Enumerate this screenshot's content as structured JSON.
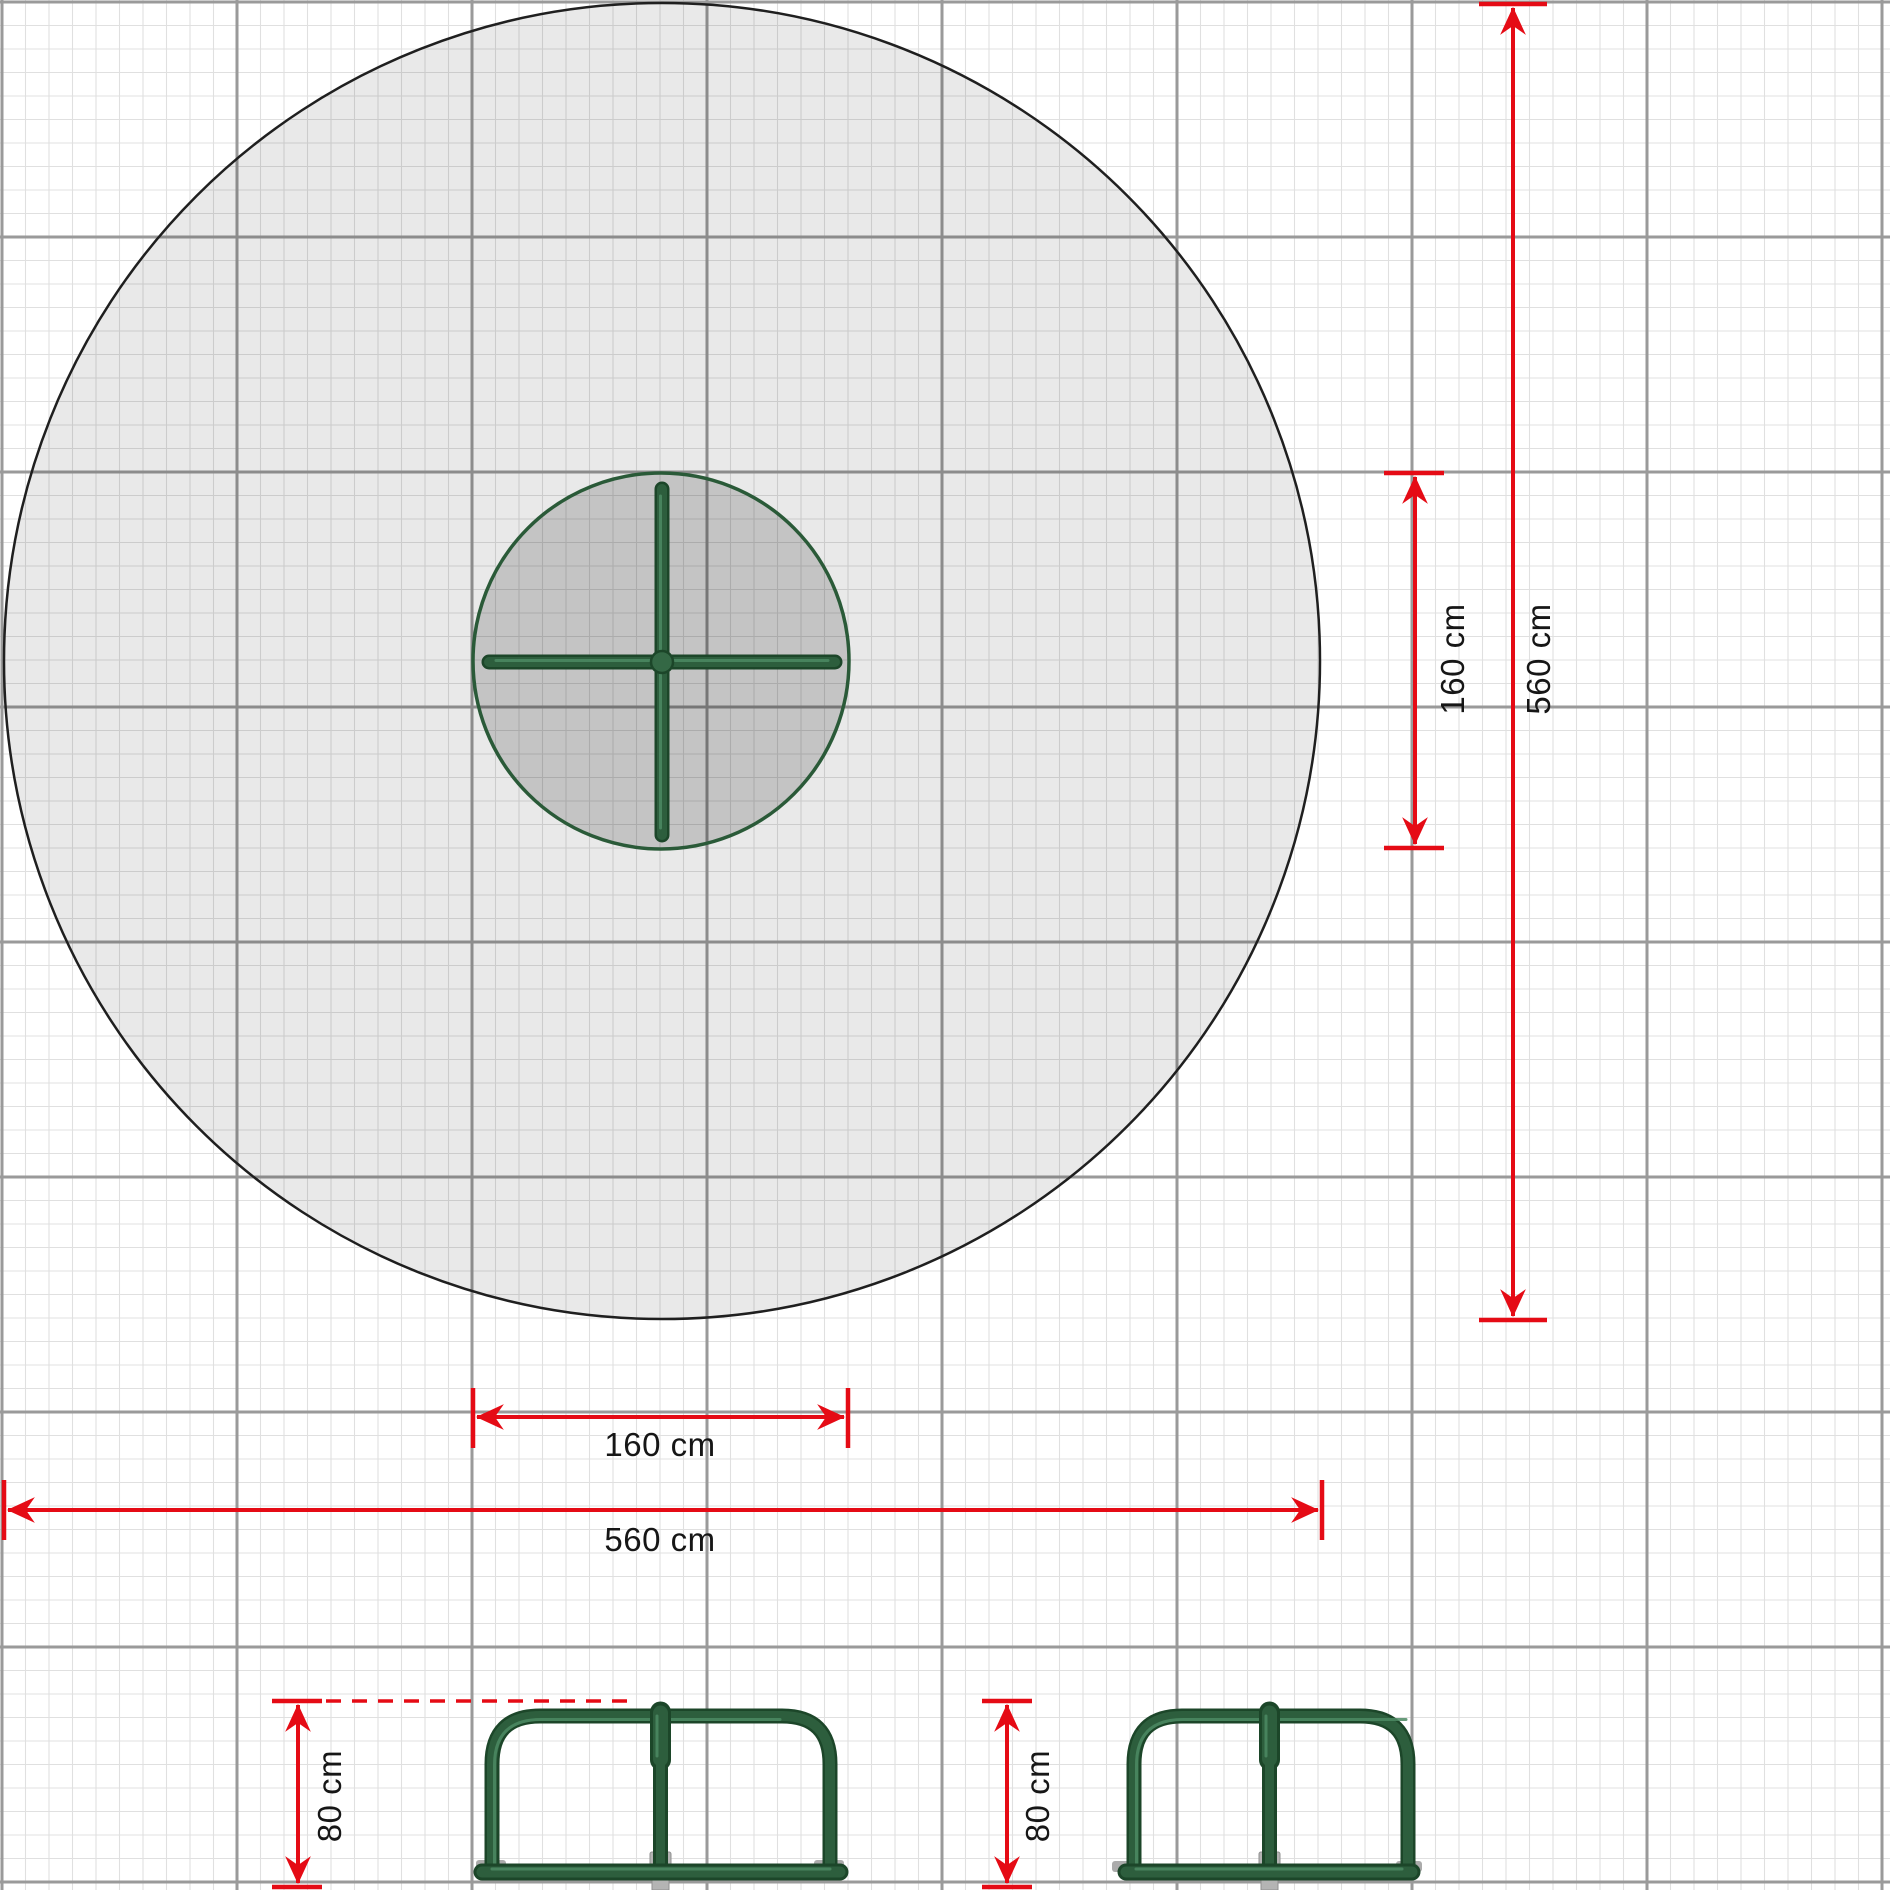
{
  "labels": {
    "plan": {
      "equipment_height": "160 cm",
      "safety_zone_height": "560 cm",
      "equipment_width": "160 cm",
      "safety_zone_width": "560 cm"
    },
    "elevations": {
      "front_height": "80 cm",
      "side_height": "80 cm"
    }
  },
  "colors": {
    "dimension_red": "#e50b15",
    "equipment_green": "#2d5e3d",
    "equipment_green_dark": "#1c4629",
    "safety_zone_fill": "#e9e9e9",
    "equipment_zone_fill": "#bfbfbf",
    "grid_fine": "#e0e0e0",
    "grid_major": "#9a9a9a",
    "pole_gray": "#b4b4b4",
    "circle_outline": "#1f1f1f"
  }
}
